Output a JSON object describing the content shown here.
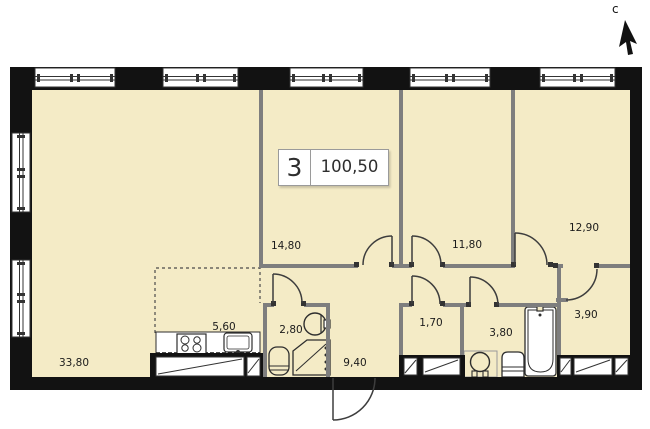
{
  "info": {
    "number": "3",
    "total_area": "100,50"
  },
  "compass": {
    "label": "с"
  },
  "rooms": [
    {
      "id": "living-room",
      "area": "33,80"
    },
    {
      "id": "kitchen",
      "area": "5,60"
    },
    {
      "id": "bedroom-1",
      "area": "14,80"
    },
    {
      "id": "bedroom-2",
      "area": "11,80"
    },
    {
      "id": "bedroom-3",
      "area": "12,90"
    },
    {
      "id": "wc",
      "area": "2,80"
    },
    {
      "id": "corridor",
      "area": "9,40"
    },
    {
      "id": "closet",
      "area": "1,70"
    },
    {
      "id": "bathroom",
      "area": "3,80"
    },
    {
      "id": "hallway",
      "area": "3,90"
    }
  ],
  "colors": {
    "floor": "#f4ebc6",
    "exterior_wall": "#121212",
    "partition": "#7e7e7e",
    "window": "#ffffff",
    "door_line": "#3d3d3d"
  }
}
